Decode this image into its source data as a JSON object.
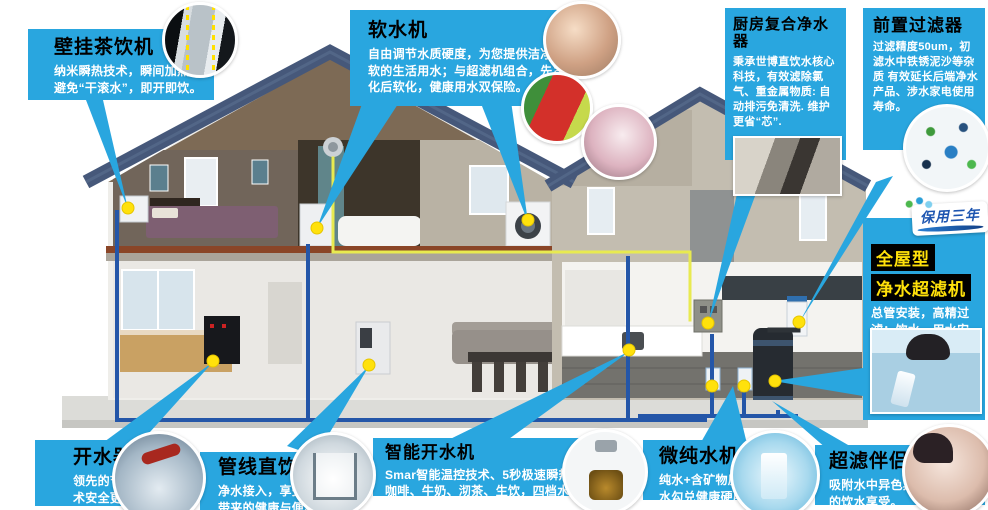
{
  "colors": {
    "callout_blue": "#29a6df",
    "title_black": "#000000",
    "body_white": "#ffffff",
    "highlight_bg": "#000000",
    "highlight_yellow": "#ffe10a",
    "badge_text_blue": "#1d55b0",
    "marker_dot_yellow": "#ffe10c",
    "pipe_blue": "#2456a8",
    "pipe_yellow": "#e8ea50",
    "roof_slate": "#46587a"
  },
  "callouts": {
    "wall_tea": {
      "title": "壁挂茶饮机",
      "body": "纳米瞬热技术，瞬间加热，避免“干滚水”，即开即饮。"
    },
    "softener": {
      "title": "软水机",
      "body": "自由调节水质硬度，为您提供洁净柔软的生活用水；与超滤机组合，先净化后软化，健康用水双保险。"
    },
    "kitchen_purifier": {
      "title": "厨房复合净水器",
      "body": "秉承世博直饮水核心科技，有效滤除氯气、重金属物质: 自动排污免清洗. 维护更省“芯”."
    },
    "prefilter": {
      "title": "前置过滤器",
      "body": "过滤精度50um，初滤水中铁锈泥沙等杂质 有效延长后端净水产品、涉水家电使用寿命。"
    },
    "whole_house": {
      "title_line1": "全屋型",
      "title_line2": "净水超滤机",
      "badge": "保用三年",
      "body": "总管安装，高精过滤；饮水、用水安全一步解决。"
    },
    "boiler": {
      "title": "开水器",
      "body": "领先的节能加热技术安全更添健康。"
    },
    "pipeline": {
      "title": "管线直饮机",
      "body": "净水接入，享受高科技带来的健康与便利。"
    },
    "smart_boiler": {
      "title": "智能开水机",
      "body": "Smar智能温控技术、5秒极速瞬热；冲咖啡、牛奶、沏茶、生饮，四档水温随心切换"
    },
    "micro_pure": {
      "title": "微纯水机",
      "body": "纯水+含矿物质水，双出水勾兑健康硬度。"
    },
    "uf_partner": {
      "title": "超滤伴侣",
      "body": "吸附水中异色异味带来沁爽的饮水享受。"
    }
  }
}
